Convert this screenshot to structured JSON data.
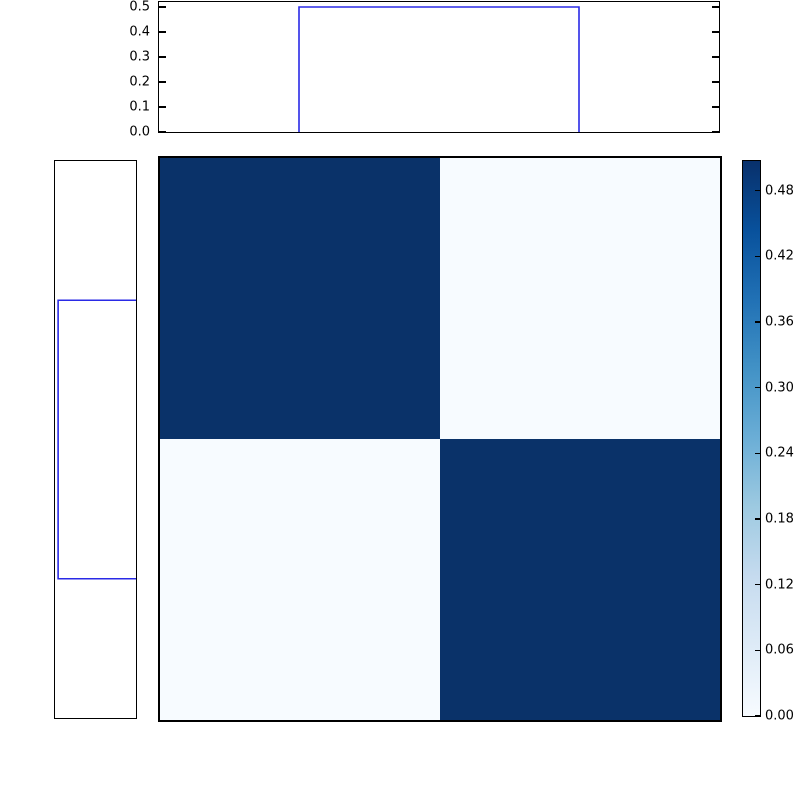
{
  "figure": {
    "background": "#ffffff",
    "frame_color": "#000000",
    "marginal_line_color": "#2a2ae6"
  },
  "chart_data": [
    {
      "id": "top_marginal",
      "type": "line",
      "role": "top marginal density, step histogram",
      "ylim": [
        0,
        0.52
      ],
      "yticks": [
        0.0,
        0.1,
        0.2,
        0.3,
        0.4,
        0.5
      ],
      "ytick_labels": [
        "0.0",
        "0.1",
        "0.2",
        "0.3",
        "0.4",
        "0.5"
      ],
      "step_x_frac": [
        0.25,
        0.75
      ],
      "step_value": 0.5,
      "line_color": "#2a2ae6",
      "grid": false,
      "tick_sides": [
        "left",
        "right"
      ]
    },
    {
      "id": "left_marginal",
      "type": "line",
      "role": "left marginal density, step histogram rotated 90deg, value axis increasing leftward",
      "xlim": [
        0,
        0.52
      ],
      "step_y_frac": [
        0.25,
        0.75
      ],
      "step_value": 0.5,
      "line_color": "#2a2ae6",
      "grid": false,
      "tick_sides": []
    },
    {
      "id": "joint_heatmap",
      "type": "heatmap",
      "matrix": [
        [
          0.5,
          0.01
        ],
        [
          0.01,
          0.5
        ]
      ],
      "vmin": 0.0,
      "vmax": 0.507,
      "cmap": "Blues",
      "color_high": "#0a3269",
      "color_low": "#f7fbff",
      "colorbar": {
        "position": "right",
        "tick_values": [
          0.48,
          0.42,
          0.36,
          0.3,
          0.24,
          0.18,
          0.12,
          0.06,
          0.0
        ],
        "tick_labels": [
          "0.48",
          "0.42",
          "0.36",
          "0.30",
          "0.24",
          "0.18",
          "0.12",
          "0.06",
          "0.00"
        ],
        "gradient_stops_top_to_bottom": [
          "#08306b",
          "#08519c",
          "#2171b5",
          "#4292c6",
          "#6baed6",
          "#9ecae1",
          "#c6dbef",
          "#deebf7",
          "#f7fbff"
        ]
      }
    }
  ]
}
